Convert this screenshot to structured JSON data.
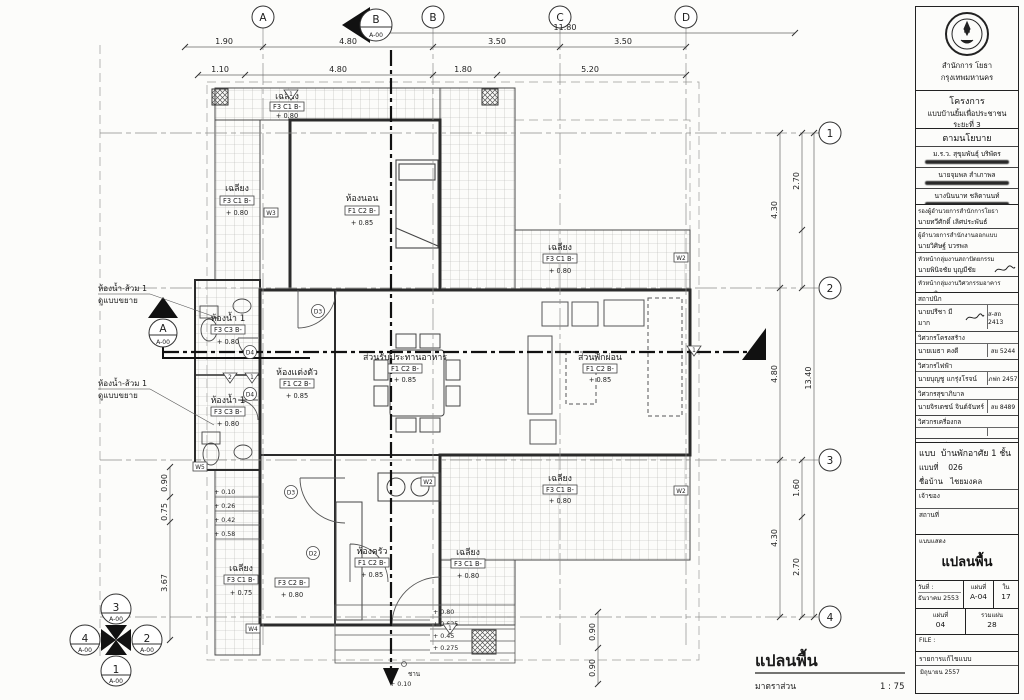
{
  "plan": {
    "grid_columns": {
      "a": "A",
      "b_cut": "B",
      "b_cut_ref": "A-00",
      "b": "B",
      "c": "C",
      "d": "D"
    },
    "grid_rows": {
      "r1": "1",
      "r2": "2",
      "r3": "3",
      "r4": "4"
    },
    "dims": {
      "top_overall": "11.80",
      "row1": [
        "1.90",
        "4.80",
        "3.50",
        "3.50"
      ],
      "row2": [
        "1.10",
        "4.80",
        "1.80",
        "5.20"
      ],
      "right_main": [
        "4.30",
        "4.80",
        "4.30"
      ],
      "right_overall": "13.40",
      "right_seg": [
        "2.70",
        "1.60",
        "2.70"
      ],
      "left": [
        "0.90",
        "0.75",
        "3.67"
      ],
      "left_steps": [
        "+ 0.10",
        "+ 0.26",
        "+ 0.42",
        "+ 0.58"
      ],
      "bottom_steps": [
        "+ 0.80",
        "+ 0.625",
        "+ 0.45",
        "+ 0.275"
      ],
      "bottom_level": "+ 0.10",
      "bottom_word": "ชาน",
      "bottom_right": [
        "0.90",
        "0.90"
      ]
    },
    "rooms": {
      "porch_top": {
        "name": "เฉลียง",
        "tag": "F3 C1 B-",
        "level": "+ 0.80"
      },
      "porch_left": {
        "name": "เฉลียง",
        "tag": "F3 C1 B-",
        "level": "+ 0.80"
      },
      "porch_topright": {
        "name": "เฉลียง",
        "tag": "F3 C1 B-",
        "level": "+ 0.80"
      },
      "bedroom": {
        "name": "ห้องนอน",
        "tag": "F1 C2 B-",
        "level": "+ 0.85"
      },
      "bath_upper": {
        "name": "ห้องน้ำ 1",
        "tag": "F3 C3 B-",
        "level": "+ 0.80"
      },
      "bath_lower": {
        "name": "ห้องน้ำ 1",
        "tag": "F3 C3 B-",
        "level": "+ 0.80"
      },
      "dressing": {
        "name": "ห้องแต่งตัว",
        "tag": "F1 C2 B-",
        "level": "+ 0.85"
      },
      "dining": {
        "name": "ส่วนรับประทานอาหาร",
        "tag": "F1 C2 B-",
        "level": "+ 0.85"
      },
      "living": {
        "name": "ส่วนพักผ่อน",
        "tag": "F1 C2 B-",
        "level": "+ 0.85"
      },
      "kitchen": {
        "name": "ห้องครัว",
        "tag": "F1 C2 B-",
        "level": "+ 0.85"
      },
      "porch_right": {
        "name": "เฉลียง",
        "tag": "F3 C1 B-",
        "level": "+ 0.80"
      },
      "porch_bottom": {
        "name": "เฉลียง",
        "tag": "F3 C1 B-",
        "level": "+ 0.80"
      },
      "porch_bottomleft": {
        "name": "เฉลียง",
        "tag": "F3 C1 B-",
        "level": "+ 0.75"
      },
      "utility": {
        "tag": "F3 C2 B-",
        "level": "+ 0.80"
      }
    },
    "callouts": {
      "bath1_line1": "ห้องน้ำ-ส้วม 1",
      "bath1_line2": "ดูแบบขยาย",
      "bath2_line1": "ห้องน้ำ-ส้วม 1",
      "bath2_line2": "ดูแบบขยาย"
    },
    "section_a": {
      "label": "A",
      "ref": "A-00"
    },
    "section_b": {
      "label": "B",
      "ref": "A-00"
    },
    "key_marker": {
      "top": "3",
      "left": "4",
      "right": "2",
      "bottom": "1",
      "ref": "A-00"
    },
    "tags": {
      "d2": "D2",
      "d3": "D3",
      "d4": "D4",
      "w2": "W2",
      "w3": "W3",
      "w4": "W4",
      "w5": "W5",
      "f1": "1",
      "f2": "2"
    },
    "footer": {
      "title": "แปลนพื้น",
      "scale_label": "มาตราส่วน",
      "scale_value": "1 : 75"
    }
  },
  "title_block": {
    "agency_line1": "สำนักการ โยธา",
    "agency_line2": "กรุงเทพมหานคร",
    "project_header": "โครงการ",
    "project_name": "แบบบ้านยิ้มเพื่อประชาชน ระยะที่ 3",
    "policy_header": "ตามนโยบาย",
    "policy_names": [
      {
        "name": "ม.ร.ว. สุขุมพันธุ์ บริพัตร"
      },
      {
        "name": "นายจุมพล สำเภาพล"
      },
      {
        "name": "นางนินนาท ชลิตานนท์"
      }
    ],
    "approvals": [
      {
        "title": "รองผู้อำนวยการสำนักการโยธา",
        "name": "นายทวีศักดิ์ เลิศประพันธ์"
      },
      {
        "title": "ผู้อำนวยการสำนักงานออกแบบ",
        "name": "นายวิศิษฐ์ บวรพล"
      },
      {
        "title": "หัวหน้ากลุ่มงานสถาปัตยกรรม",
        "name": "นายพินิจชัย บุญมีชัย"
      },
      {
        "title": "หัวหน้ากลุ่มงานวิศวกรรมอาคาร",
        "name": "นายสุจิระ ผลอวยพร"
      }
    ],
    "designers": [
      {
        "title": "สถาปนิก",
        "name": "นายปรีชา มีมาก",
        "license": "ส-สถ 2413"
      },
      {
        "title": "วิศวกรโครงสร้าง",
        "name": "นายเมธา คงดี",
        "license": "สย 5244"
      },
      {
        "title": "วิศวกรไฟฟ้า",
        "name": "นายบุญชู แกรุ่งโรจน์",
        "license": "ภฟก 2457"
      },
      {
        "title": "วิศวกรสุขาภิบาล",
        "name": "นายจิรเดชน์ จินต์จันทร์",
        "license": "สย 8489"
      },
      {
        "title": "วิศวกรเครื่องกล",
        "name": "",
        "license": ""
      },
      {
        "title": "นายช่างเขียนแบบ",
        "name": "นายอนุสรณ์ แป้นคำ",
        "license": ""
      }
    ],
    "info": {
      "type_label": "แบบ",
      "type_value": "บ้านพักอาศัย 1 ชั้น",
      "no_label": "แบบที่",
      "no_value": "026",
      "house_label": "ชื่อบ้าน",
      "house_value": "ไชยมงคล",
      "owner_label": "เจ้าของ",
      "site_label": "สถานที่"
    },
    "shows_label": "แบบแสดง",
    "shows_value": "แปลนพื้น",
    "date_label": "วันที่ :",
    "date_value": "ธันวาคม 2553",
    "sheet_label": "แผ่นที่",
    "sheet_value": "A-04",
    "of_label": "ใน",
    "of_value": "17",
    "sheet2_label": "แผ่นที่",
    "sheet2_value": "04",
    "total_label": "รวมแผ่น",
    "total_value": "28",
    "file_label": "FILE :",
    "rev_header": "รายการแก้ไขแบบ",
    "rev_value": "มิถุนายน 2557"
  }
}
